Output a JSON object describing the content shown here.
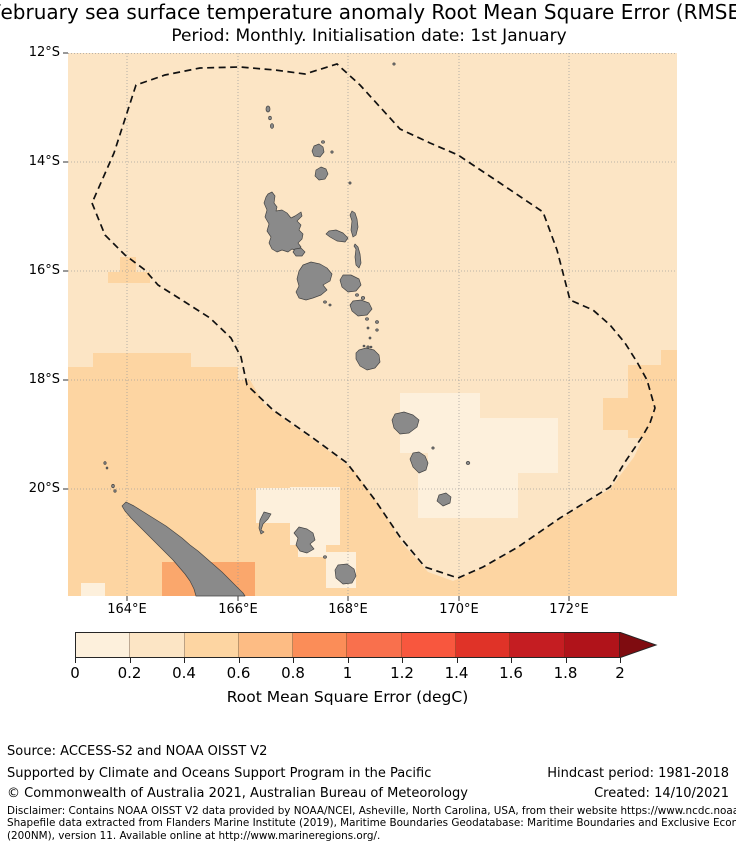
{
  "title": {
    "line1": "February sea surface temperature anomaly Root Mean Square Error (RMSE)",
    "line2": "Period: Monthly. Initialisation date: 1st January"
  },
  "map": {
    "lat_labels": [
      "12°S",
      "14°S",
      "16°S",
      "18°S",
      "20°S"
    ],
    "lon_labels": [
      "164°E",
      "166°E",
      "168°E",
      "170°E",
      "172°E"
    ]
  },
  "colorbar": {
    "label": "Root Mean Square Error (degC)",
    "tick_labels": [
      "0",
      "0.2",
      "0.4",
      "0.6",
      "0.8",
      "1",
      "1.2",
      "1.4",
      "1.6",
      "1.8",
      "2"
    ],
    "segment_colors": [
      "#fdf0dc",
      "#fce5c5",
      "#fdd5a2",
      "#fdbc84",
      "#fb8d58",
      "#f9704d",
      "#f8573e",
      "#e03328",
      "#c51d22",
      "#b0131a"
    ],
    "extend_color": "#7f0c10"
  },
  "chart_data": {
    "type": "heatmap",
    "title": "February sea surface temperature anomaly Root Mean Square Error (RMSE)",
    "subtitle": "Period: Monthly. Initialisation date: 1st January",
    "x_axis": {
      "ticks": [
        "164°E",
        "166°E",
        "168°E",
        "170°E",
        "172°E"
      ],
      "approx_range_deg_east": [
        162.9,
        174.0
      ]
    },
    "y_axis": {
      "ticks": [
        "12°S",
        "14°S",
        "16°S",
        "18°S",
        "20°S"
      ],
      "approx_range_deg_south": [
        12,
        22
      ]
    },
    "colorbar": {
      "label": "Root Mean Square Error (degC)",
      "ticks": [
        0,
        0.2,
        0.4,
        0.6,
        0.8,
        1,
        1.2,
        1.4,
        1.6,
        1.8,
        2
      ],
      "extend": "max",
      "bin_width": 0.2
    },
    "field_summary": [
      {
        "region": "most of map / northern and central Vanuatu EEZ",
        "rmse_degC": "0.2-0.4"
      },
      {
        "region": "south-west quadrant around New Caledonia (south of ~17.5°S)",
        "rmse_degC": "0.4-0.6"
      },
      {
        "region": "patch immediately south-west of New Caledonia",
        "rmse_degC": "0.6-0.8"
      },
      {
        "region": "south-east corner outside EEZ boundary",
        "rmse_degC": "0.4-0.6"
      },
      {
        "region": "around southern Vanuatu islands (Erromango, Tanna, Aneityum)",
        "rmse_degC": "0.0-0.2"
      },
      {
        "region": "around Loyalty Islands (Ouvéa, Lifou, Maré)",
        "rmse_degC": "0.0-0.2"
      },
      {
        "region": "small patch near 16°S, 163.7°E",
        "rmse_degC": "0.4-0.6"
      }
    ],
    "overlays": [
      "dashed Exclusive Economic Zone boundary polygon",
      "grey island landmasses (Vanuatu archipelago, New Caledonia, Loyalty Islands)"
    ]
  },
  "footer": {
    "source": "Source: ACCESS-S2 and NOAA OISST V2",
    "supported": "Supported by Climate and Oceans Support Program in the Pacific",
    "copyright": "© Commonwealth of Australia 2021, Australian Bureau of Meteorology",
    "hindcast": "Hindcast period: 1981-2018",
    "created": "Created: 14/10/2021",
    "disclaimer_lines": [
      "Disclaimer: Contains NOAA OISST V2 data provided by NOAA/NCEI, Asheville, North Carolina, USA, from their website https://www.ncdc.noaa.gov/oisst.",
      "Shapefile data extracted from Flanders Marine Institute (2019), Maritime Boundaries Geodatabase: Maritime Boundaries and Exclusive Economic Zones",
      "(200NM), version 11. Available online at http://www.marineregions.org/."
    ]
  }
}
